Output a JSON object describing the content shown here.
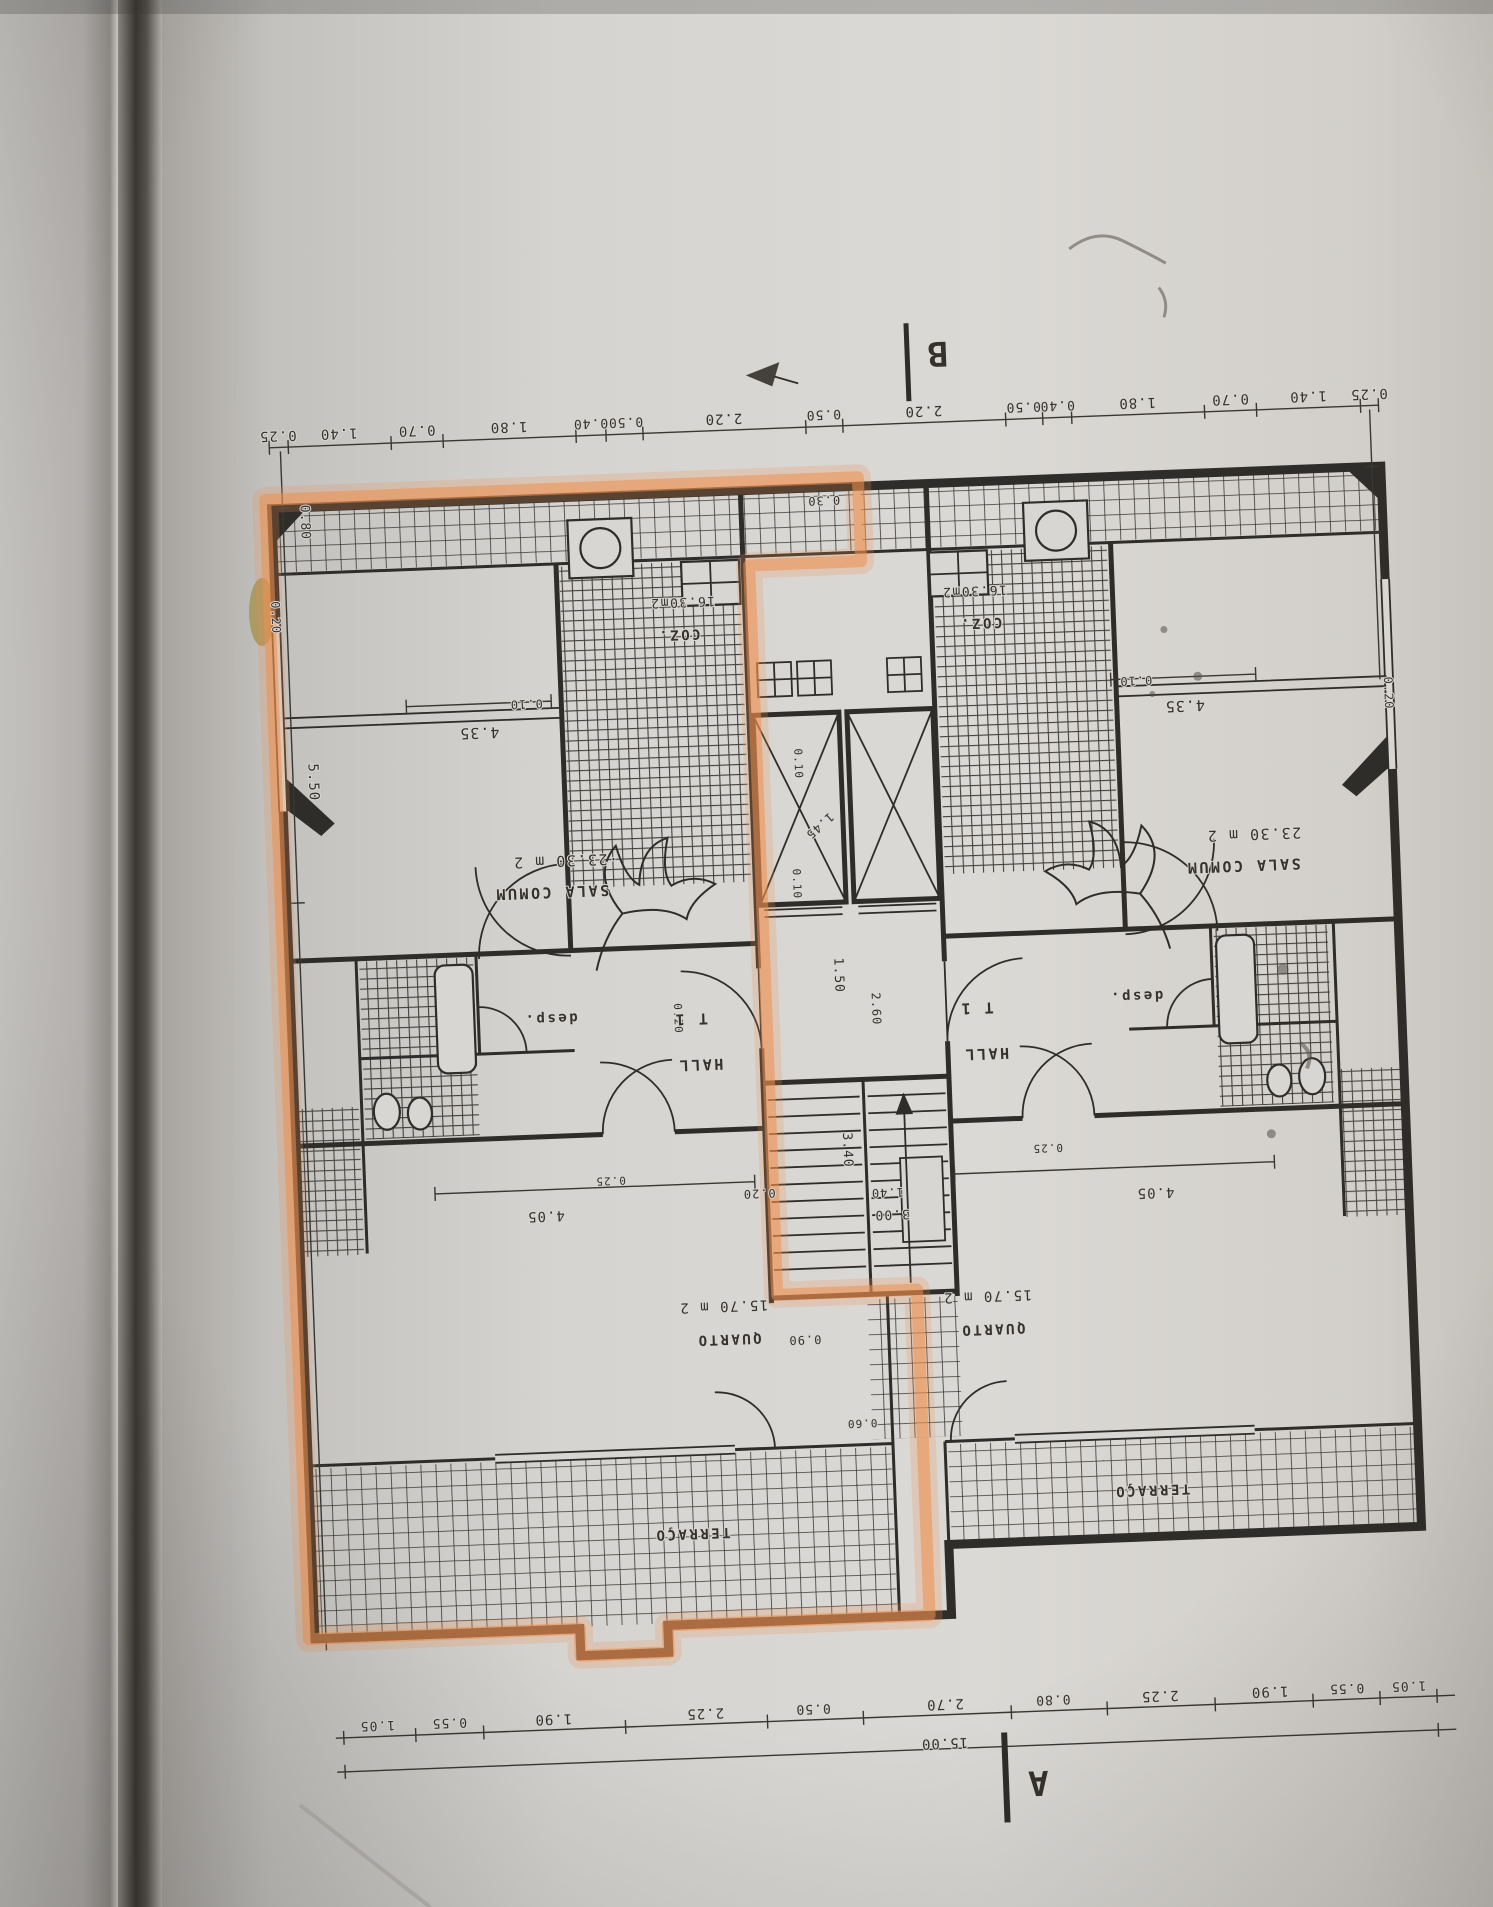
{
  "plan": {
    "section_marks": {
      "a": "A",
      "b": "B"
    },
    "highlight_color": "#ef8f4d",
    "total_width": "15.00",
    "apartments": {
      "left": {
        "type": "T 1",
        "sala": "SALA COMUM",
        "sala_area": "·23.30 m 2",
        "kitchen": "COZ.",
        "kitchen_area": "16.30m2",
        "hall": "HALL",
        "pantry": "desp.",
        "bedroom": "QUARTO",
        "bedroom_area": "15.70 m 2",
        "terrace": "TERRAÇO"
      },
      "right": {
        "type": "T 1",
        "sala": "SALA COMUM",
        "sala_area": "23.30 m 2",
        "kitchen": "COZ.",
        "kitchen_area": "16.30m2",
        "hall": "HALL",
        "pantry": "desp.",
        "bedroom": "QUARTO",
        "bedroom_area": "15.70 m 2",
        "terrace": "TERRAÇO"
      }
    },
    "dimensions": {
      "top_row": [
        "0.25",
        "1.40",
        "0.70",
        "1.80",
        "0.40",
        "0.50",
        "2.20",
        "0.50",
        "2.20",
        "0.50",
        "0.40",
        "1.80",
        "0.70",
        "1.40",
        "0.25"
      ],
      "bottom_row": [
        "1.05",
        "0.55",
        "1.90",
        "2.25",
        "0.50",
        "2.70",
        "0.80",
        "2.25",
        "1.90",
        "0.55",
        "1.05"
      ],
      "left_side": [
        "0.80",
        "0.20",
        "5.50"
      ],
      "right_side": [
        "0.20"
      ],
      "interior": [
        "0.10",
        "4.35",
        "0.30",
        "1.45",
        "1.50",
        "2.60",
        "0.20",
        "3.40",
        "3.00",
        "0.90",
        "0.25",
        "4.05",
        "1.40",
        "0.60"
      ]
    },
    "labels": [
      {
        "n": "dim-label",
        "t": "0.25",
        "x": 302,
        "y": 410,
        "s": 14
      },
      {
        "n": "dim-label",
        "t": "1.40",
        "x": 363,
        "y": 410,
        "s": 14
      },
      {
        "n": "dim-label",
        "t": "0.70",
        "x": 441,
        "y": 410,
        "s": 14
      },
      {
        "n": "dim-label",
        "t": "1.80",
        "x": 533,
        "y": 410,
        "s": 14
      },
      {
        "n": "dim-label",
        "t": "0.40",
        "x": 615,
        "y": 410,
        "s": 13
      },
      {
        "n": "dim-label",
        "t": "0.50",
        "x": 650,
        "y": 410,
        "s": 13
      },
      {
        "n": "dim-label",
        "t": "2.20",
        "x": 748,
        "y": 410,
        "s": 14
      },
      {
        "n": "dim-label",
        "t": "0.50",
        "x": 848,
        "y": 410,
        "s": 13
      },
      {
        "n": "dim-label",
        "t": "2.20",
        "x": 948,
        "y": 410,
        "s": 14
      },
      {
        "n": "dim-label",
        "t": "0.50",
        "x": 1048,
        "y": 410,
        "s": 13
      },
      {
        "n": "dim-label",
        "t": "0.40",
        "x": 1082,
        "y": 410,
        "s": 13
      },
      {
        "n": "dim-label",
        "t": "1.80",
        "x": 1162,
        "y": 410,
        "s": 14
      },
      {
        "n": "dim-label",
        "t": "0.70",
        "x": 1255,
        "y": 410,
        "s": 14
      },
      {
        "n": "dim-label",
        "t": "1.40",
        "x": 1333,
        "y": 410,
        "s": 14
      },
      {
        "n": "dim-label",
        "t": "0.25",
        "x": 1394,
        "y": 410,
        "s": 14
      },
      {
        "n": "dim-label",
        "t": "0.80",
        "x": 322,
        "y": 502,
        "s": 13,
        "r": 90
      },
      {
        "n": "dim-label",
        "t": "0.20",
        "x": 289,
        "y": 596,
        "s": 12,
        "r": 90
      },
      {
        "n": "dim-label",
        "t": "5.50",
        "x": 320,
        "y": 762,
        "s": 14,
        "r": 90
      },
      {
        "n": "dim-label",
        "t": "0.20",
        "x": 1398,
        "y": 714,
        "s": 12,
        "r": 90
      },
      {
        "n": "dim-label",
        "t": "0.10",
        "x": 540,
        "y": 688,
        "s": 12
      },
      {
        "n": "dim-label",
        "t": "4.35",
        "x": 492,
        "y": 714,
        "s": 15
      },
      {
        "n": "dim-label",
        "t": "0.30",
        "x": 845,
        "y": 496,
        "s": 12
      },
      {
        "n": "dim-label",
        "t": "0.10",
        "x": 1150,
        "y": 688,
        "s": 12
      },
      {
        "n": "dim-label",
        "t": "4.35",
        "x": 1198,
        "y": 714,
        "s": 15
      },
      {
        "n": "area-label",
        "t": "16.30m2",
        "x": 700,
        "y": 592,
        "s": 13,
        "c": "area"
      },
      {
        "n": "room-label",
        "t": "COZ.",
        "x": 695,
        "y": 624,
        "s": 14,
        "c": "room"
      },
      {
        "n": "area-label",
        "t": "16.30m2",
        "x": 992,
        "y": 592,
        "s": 13,
        "c": "area"
      },
      {
        "n": "room-label",
        "t": "COZ.",
        "x": 997,
        "y": 624,
        "s": 14,
        "c": "room"
      },
      {
        "n": "area-label",
        "t": "·23.30 m 2",
        "x": 573,
        "y": 845,
        "s": 15,
        "c": "area"
      },
      {
        "n": "room-label",
        "t": "SALA COMUM",
        "x": 558,
        "y": 876,
        "s": 15,
        "c": "room"
      },
      {
        "n": "area-label",
        "t": "23.30 m 2",
        "x": 1262,
        "y": 845,
        "s": 15,
        "c": "area"
      },
      {
        "n": "room-label",
        "t": "SALA COMUM",
        "x": 1250,
        "y": 876,
        "s": 15,
        "c": "room"
      },
      {
        "n": "dim-label",
        "t": "0.10",
        "x": 806,
        "y": 762,
        "s": 11,
        "r": 90
      },
      {
        "n": "dim-label",
        "t": "1.45",
        "x": 826,
        "y": 822,
        "s": 12,
        "r": 140
      },
      {
        "n": "dim-label",
        "t": "0.10",
        "x": 800,
        "y": 882,
        "s": 11,
        "r": 90
      },
      {
        "n": "dim-label",
        "t": "1.50",
        "x": 838,
        "y": 975,
        "s": 13,
        "r": 90
      },
      {
        "n": "dim-label",
        "t": "2.60",
        "x": 874,
        "y": 1010,
        "s": 12,
        "r": 90
      },
      {
        "n": "dim-label",
        "t": "0.20",
        "x": 676,
        "y": 1012,
        "s": 11,
        "r": 90
      },
      {
        "n": "room-label",
        "t": "desp.",
        "x": 552,
        "y": 1003,
        "s": 14,
        "c": "room"
      },
      {
        "n": "room-label",
        "t": "T 1",
        "x": 692,
        "y": 1008,
        "s": 15,
        "c": "room"
      },
      {
        "n": "room-label",
        "t": "HALL",
        "x": 700,
        "y": 1054,
        "s": 15,
        "c": "room"
      },
      {
        "n": "room-label",
        "t": "desp.",
        "x": 1138,
        "y": 1003,
        "s": 14,
        "c": "room"
      },
      {
        "n": "room-label",
        "t": "T 1",
        "x": 978,
        "y": 1008,
        "s": 15,
        "c": "room"
      },
      {
        "n": "room-label",
        "t": "HALL",
        "x": 986,
        "y": 1054,
        "s": 15,
        "c": "room"
      },
      {
        "n": "dim-label",
        "t": "3.40",
        "x": 840,
        "y": 1150,
        "s": 13,
        "r": 90
      },
      {
        "n": "dim-label",
        "t": "3.00",
        "x": 886,
        "y": 1212,
        "s": 13
      },
      {
        "n": "dim-label",
        "t": "0.20",
        "x": 754,
        "y": 1186,
        "s": 12
      },
      {
        "n": "dim-label",
        "t": "0.90",
        "x": 794,
        "y": 1334,
        "s": 12
      },
      {
        "n": "dim-label",
        "t": "0.25",
        "x": 606,
        "y": 1168,
        "s": 11
      },
      {
        "n": "dim-label",
        "t": "4.05",
        "x": 540,
        "y": 1200,
        "s": 14
      },
      {
        "n": "dim-label",
        "t": "0.25",
        "x": 1044,
        "y": 1152,
        "s": 11
      },
      {
        "n": "dim-label",
        "t": "4.05",
        "x": 1150,
        "y": 1200,
        "s": 14
      },
      {
        "n": "dim-label",
        "t": "1.40",
        "x": 882,
        "y": 1190,
        "s": 12
      },
      {
        "n": "area-label",
        "t": "15.70 m 2",
        "x": 714,
        "y": 1297,
        "s": 14,
        "c": "area"
      },
      {
        "n": "room-label",
        "t": "QUARTO",
        "x": 718,
        "y": 1330,
        "s": 14,
        "c": "room"
      },
      {
        "n": "area-label",
        "t": "15.70 m 2",
        "x": 978,
        "y": 1297,
        "s": 14,
        "c": "area"
      },
      {
        "n": "room-label",
        "t": "QUARTO",
        "x": 982,
        "y": 1330,
        "s": 14,
        "c": "room"
      },
      {
        "n": "dim-label",
        "t": "0.60",
        "x": 848,
        "y": 1420,
        "s": 11
      },
      {
        "n": "room-label",
        "t": "TERRAÇO",
        "x": 674,
        "y": 1523,
        "s": 14,
        "c": "room"
      },
      {
        "n": "room-label",
        "t": "TERRAÇO",
        "x": 1135,
        "y": 1497,
        "s": 14,
        "c": "room"
      },
      {
        "n": "dim-label",
        "t": "1.05",
        "x": 352,
        "y": 1703,
        "s": 13
      },
      {
        "n": "dim-label",
        "t": "0.55",
        "x": 424,
        "y": 1703,
        "s": 13
      },
      {
        "n": "dim-label",
        "t": "1.90",
        "x": 528,
        "y": 1703,
        "s": 14
      },
      {
        "n": "dim-label",
        "t": "2.25",
        "x": 680,
        "y": 1703,
        "s": 14
      },
      {
        "n": "dim-label",
        "t": "0.50",
        "x": 788,
        "y": 1703,
        "s": 13
      },
      {
        "n": "dim-label",
        "t": "2.70",
        "x": 920,
        "y": 1703,
        "s": 14
      },
      {
        "n": "dim-label",
        "t": "0.80",
        "x": 1028,
        "y": 1703,
        "s": 13
      },
      {
        "n": "dim-label",
        "t": "2.25",
        "x": 1135,
        "y": 1703,
        "s": 14
      },
      {
        "n": "dim-label",
        "t": "1.90",
        "x": 1245,
        "y": 1703,
        "s": 14
      },
      {
        "n": "dim-label",
        "t": "0.55",
        "x": 1322,
        "y": 1703,
        "s": 13
      },
      {
        "n": "dim-label",
        "t": "1.05",
        "x": 1384,
        "y": 1703,
        "s": 13
      },
      {
        "n": "dim-label",
        "t": "15.00",
        "x": 918,
        "y": 1742,
        "s": 14
      }
    ]
  }
}
